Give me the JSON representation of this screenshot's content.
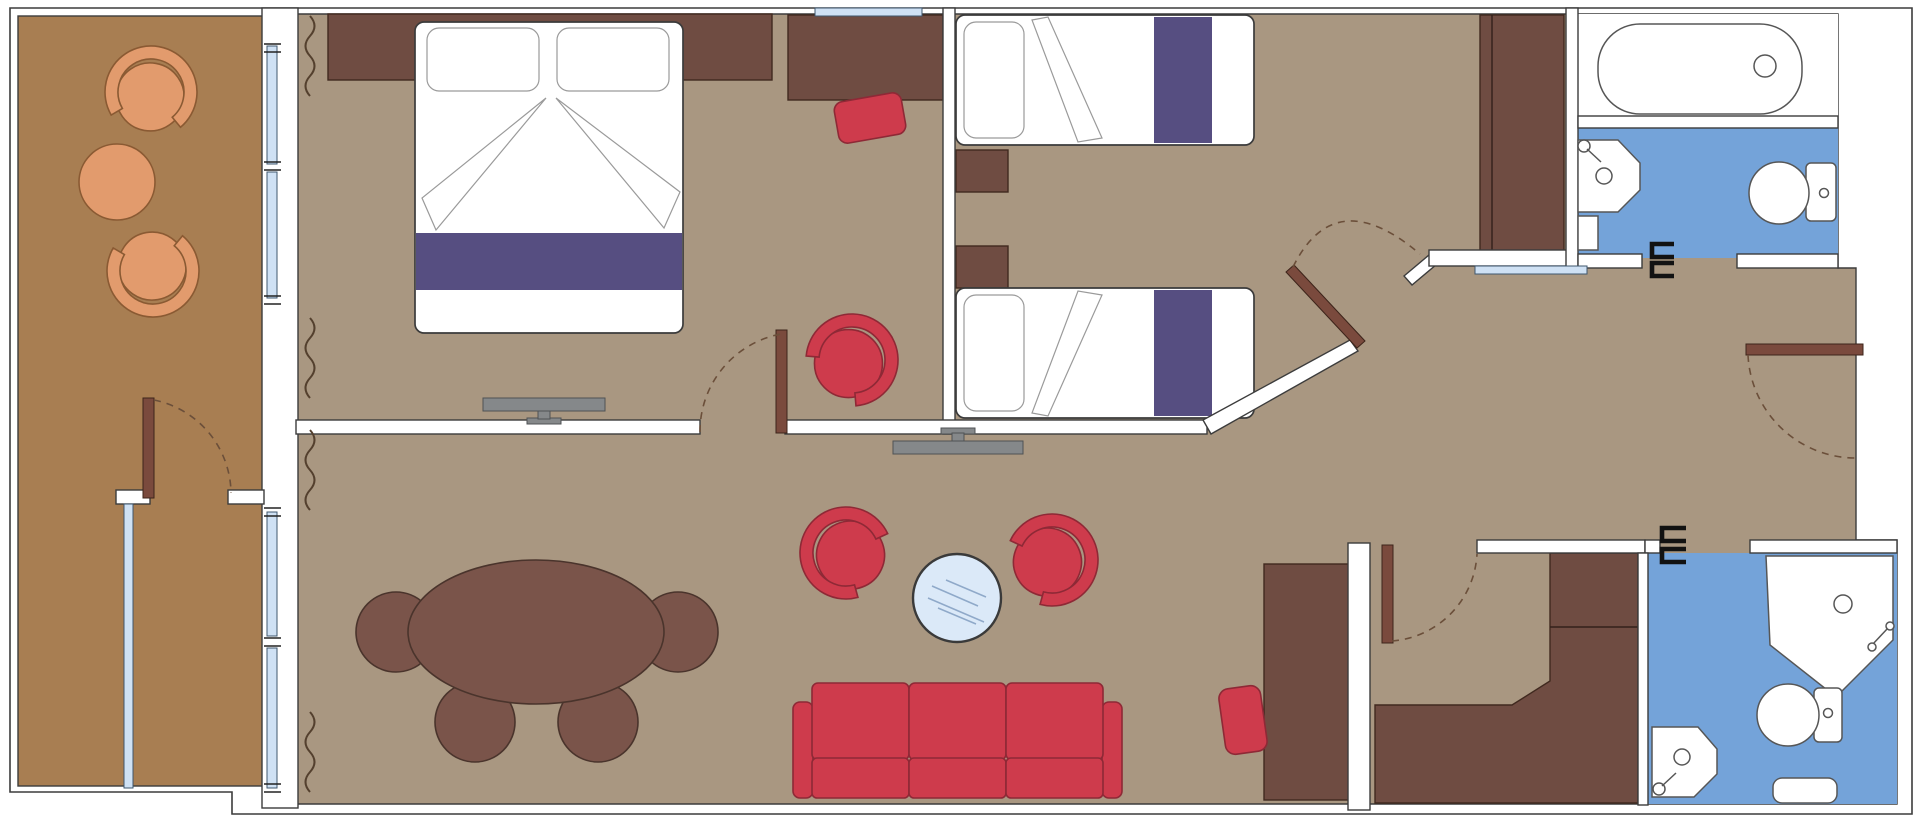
{
  "meta": {
    "type": "floor-plan",
    "view": "top-down",
    "description": "Suite floor plan with balcony, master bedroom, twin bedroom, living-dining area, hallway, walk-in closet and two bathrooms"
  },
  "colors": {
    "outline": "#3c3c3c",
    "wall": "#ffffff",
    "floor": "#a99781",
    "balcony_floor": "#a87e52",
    "dark_wood": "#6f4c42",
    "door_wood": "#7a4a3d",
    "red": "#ce3b4c",
    "red_outline": "#8e2936",
    "purple": "#564e81",
    "bath_blue": "#74a3d9",
    "glass": "#cfe1f4",
    "glass_table": "#dbe9f8",
    "orange": "#e29b6d",
    "table_wood": "#7a544a",
    "tv_gray": "#85888a"
  },
  "rooms": {
    "balcony": {
      "tub_chairs": 2,
      "round_table": 1,
      "glass_divider": 1,
      "divider_door": 1
    },
    "master_bedroom": {
      "double_bed": 1,
      "pillows": 2,
      "headboard_cabinet": 1,
      "nightstand": 1,
      "tv": 1,
      "window_sections": 2
    },
    "dressing_nook": {
      "desk": 1,
      "desk_chair": 1,
      "armchair": 1,
      "window": 1
    },
    "twin_bedroom": {
      "single_beds": 2,
      "nightstands": 2,
      "wardrobe": 1,
      "mirror_panel": 1
    },
    "living_room": {
      "sofa_seats": 3,
      "armchairs": 2,
      "glass_coffee_table": 1,
      "dining_table": 1,
      "dining_chairs": 4,
      "tv": 1,
      "cabinet": 1,
      "stool": 1
    },
    "hallway": {
      "entry_door": 1,
      "closet_door": 1
    },
    "walk_in_closet": {
      "l_counter": 1
    },
    "bathroom_main": {
      "bathtub": 1,
      "sink": 1,
      "toilet": 1,
      "door_brackets": 2
    },
    "bathroom_second": {
      "shower": 1,
      "sink": 1,
      "toilet": 1,
      "mat": 1,
      "door_brackets": 2
    }
  },
  "door_swings": 5,
  "curtain_marks": 4
}
